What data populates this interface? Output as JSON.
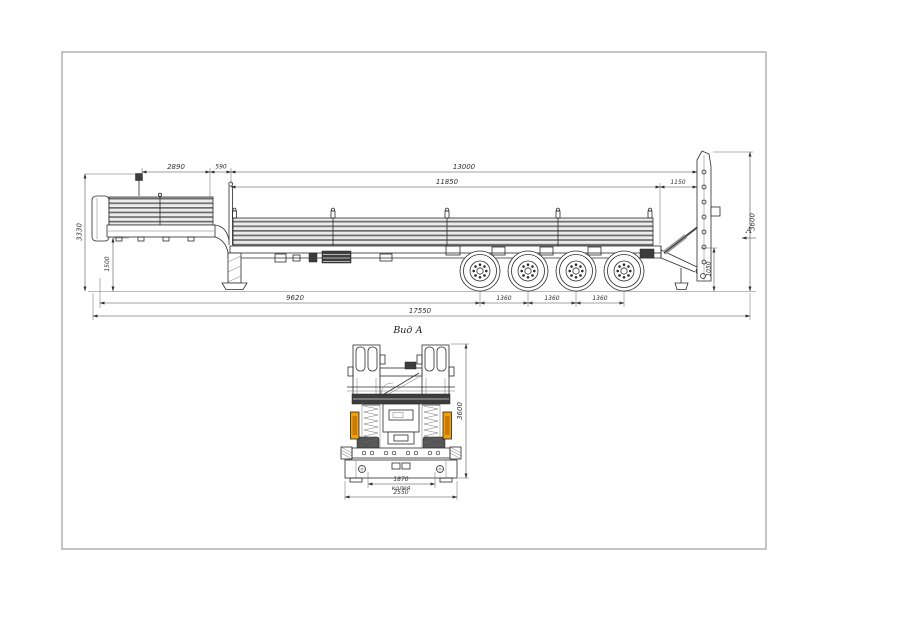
{
  "page": {
    "frame_color": "#ababab",
    "background": "#ffffff"
  },
  "colors": {
    "line": "#2b2b2b",
    "marker_orange": "#f2a007",
    "marker_core": "#c97a00"
  },
  "side_view": {
    "dims_top": {
      "gooseneck_length": "2890",
      "neck_gap": "590",
      "platform_total": "13000",
      "platform_inner": "11850",
      "rear_section": "1150"
    },
    "dims_left": {
      "overall_height": "3330",
      "deck_height": "1500"
    },
    "dims_right": {
      "ramp_height": "3600",
      "rear_frame_height": "1050"
    },
    "dims_bottom": {
      "front_to_first_axle": "9620",
      "axle_spacings": [
        "1360",
        "1360",
        "1360"
      ],
      "overall_length": "17550"
    },
    "view_arrow_label": "A"
  },
  "rear_view": {
    "title": "Вид А",
    "dims": {
      "overall_height": "3600",
      "track_width": "1870",
      "track_caption": "колея",
      "overall_width": "2550"
    }
  }
}
